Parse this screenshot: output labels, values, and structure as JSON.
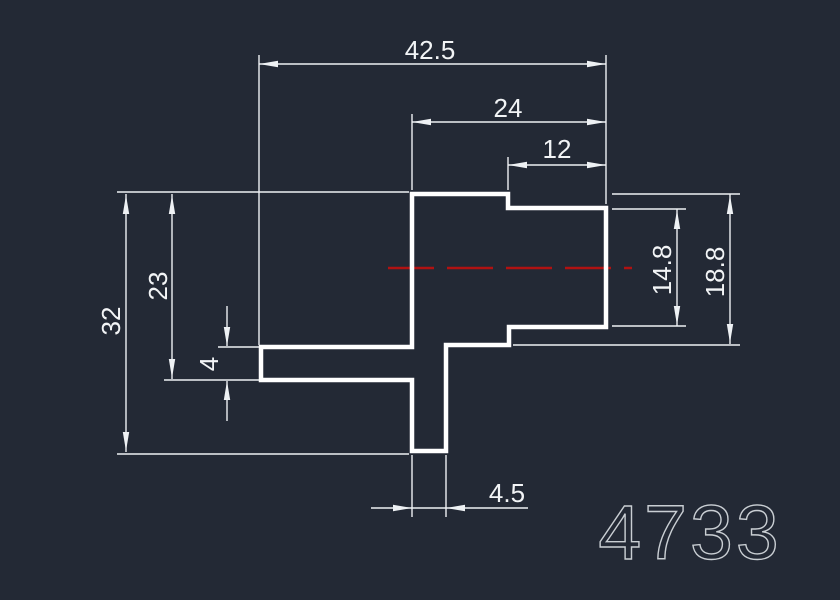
{
  "drawing": {
    "number": "4733",
    "dim_labels": {
      "overall_width": "42.5",
      "upper_width": "24",
      "neck_width": "12",
      "overall_height": "32",
      "left_height": "23",
      "flange_thickness": "4",
      "boss_inner_height": "14.8",
      "boss_outer_height": "18.8",
      "stem_width": "4.5"
    }
  },
  "colors": {
    "background": "#232935",
    "part_line": "#ffffff",
    "dim_line": "#eef1f4",
    "dim_text": "#f2f4f6",
    "centerline": "#b01212",
    "title_text": "#c9ced3"
  }
}
